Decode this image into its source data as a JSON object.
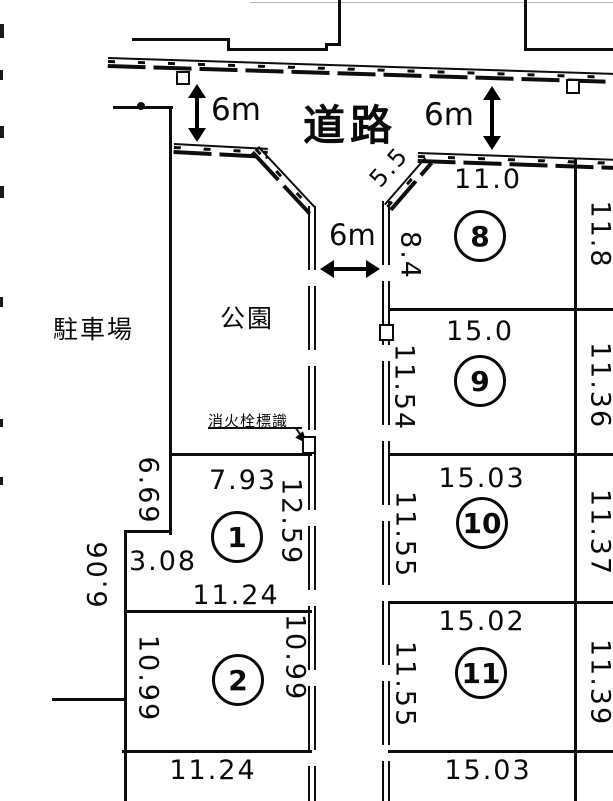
{
  "labels": {
    "road": "道路",
    "park": "公園",
    "parking": "駐車場",
    "hydrant_sign": "消火栓標識"
  },
  "road_dims": {
    "top_left_width": "6m",
    "top_right_width": "6m",
    "middle_width": "6m",
    "chamfer": "5.5"
  },
  "plots": {
    "p1": {
      "number": "1",
      "top": "7.93",
      "left_upper": "6.69",
      "left_step": "3.08",
      "outer_left": "6.06",
      "right": "12.59",
      "bottom": "11.24"
    },
    "p2": {
      "number": "2",
      "left": "10.99",
      "right": "10.99",
      "bottom": "11.24"
    },
    "p8": {
      "number": "8",
      "top": "11.0",
      "left": "8.4",
      "right": "11.8"
    },
    "p9": {
      "number": "9",
      "top": "15.0",
      "left": "11.54",
      "right": "11.36"
    },
    "p10": {
      "number": "10",
      "top": "15.03",
      "left": "11.55",
      "right": "11.37"
    },
    "p11": {
      "number": "11",
      "top": "15.02",
      "left": "11.55",
      "right": "11.39",
      "bottom": "15.03"
    }
  }
}
